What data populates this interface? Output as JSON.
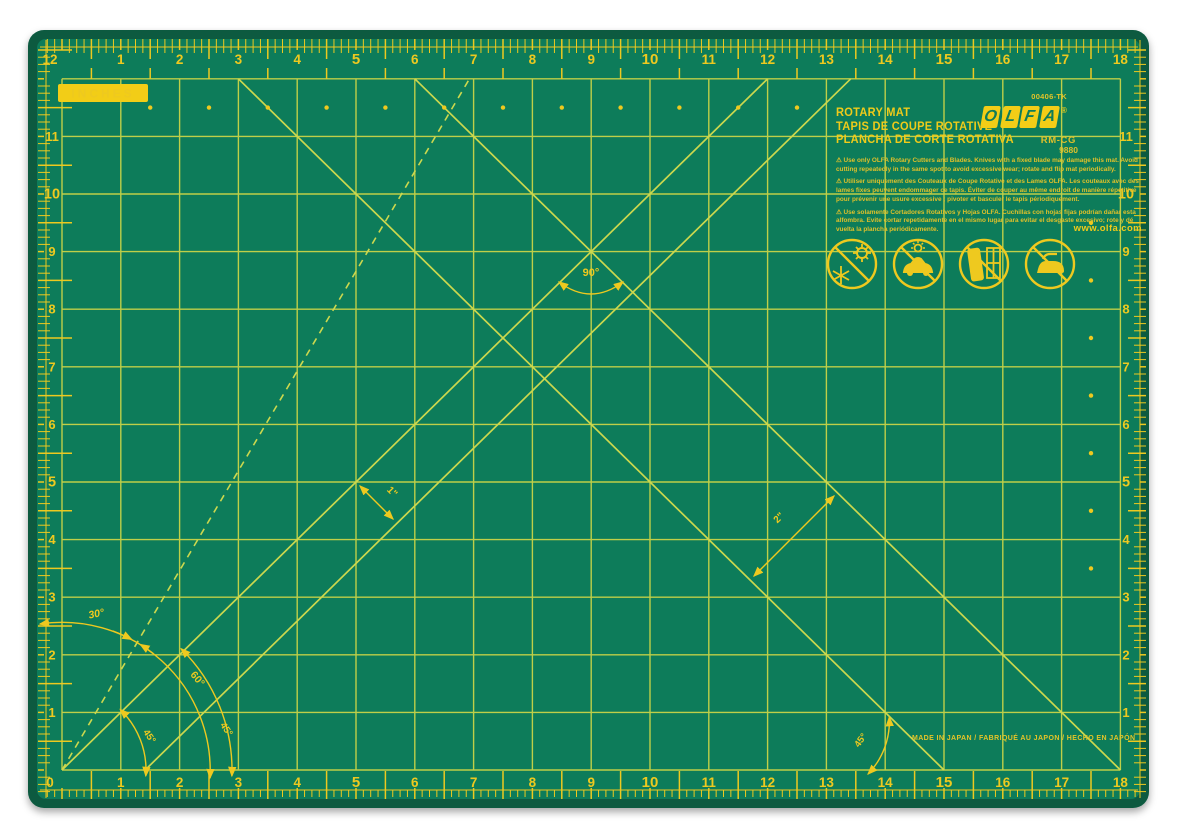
{
  "mat": {
    "unit_label": "INCHES",
    "brand": {
      "name": "OLFA",
      "letters": [
        "O",
        "L",
        "F",
        "A"
      ],
      "registered": "®"
    },
    "sku": "00406-TK",
    "model": "RM-CG",
    "model_number": "9880",
    "product_names": {
      "en": "ROTARY MAT",
      "fr": "TAPIS DE COUPE ROTATIVE",
      "es": "PLANCHA DE CORTE ROTATIVA"
    },
    "warnings": {
      "en": "⚠ Use only OLFA Rotary Cutters and Blades. Knives with a fixed blade may damage this mat. Avoid cutting repeatedly in the same spot to avoid excessive wear; rotate and flip mat periodically.",
      "fr": "⚠ Utiliser uniquement des Couteaux de Coupe Rotative et des Lames OLFA. Les couteaux avec des lames fixes peuvent endommager ce tapis. Éviter de couper au même endroit de manière répétitive pour prévenir une usure excessive ; pivoter et basculer le tapis périodiquement.",
      "es": "⚠ Use solamente Cortadores Rotativos y Hojas OLFA. Cuchillas con hojas fijas podrían dañar esta alfombra. Evite cortar repetidamente en el mismo lugar para evitar el desgaste excesivo; rote y dé vuelta la plancha periódicamente."
    },
    "website": "www.olfa.com",
    "made_in": "MADE IN  JAPAN / FABRIQUÉ AU JAPON / HECHO EN JAPÓN",
    "markings": {
      "right_angle": "90°",
      "angle_30": "30°",
      "angle_60": "60°",
      "angle_45": "45°",
      "one_inch": "1\"",
      "two_inch": "2\""
    },
    "rulers": {
      "top_numbers": [
        "1",
        "2",
        "3",
        "4",
        "5",
        "6",
        "7",
        "8",
        "9",
        "10",
        "11",
        "12",
        "13",
        "14",
        "15",
        "16",
        "17",
        "18"
      ],
      "bottom_numbers": [
        "1",
        "2",
        "3",
        "4",
        "5",
        "6",
        "7",
        "8",
        "9",
        "10",
        "11",
        "12",
        "13",
        "14",
        "15",
        "16",
        "17",
        "18"
      ],
      "left_numbers": [
        "1",
        "2",
        "3",
        "4",
        "5",
        "6",
        "7",
        "8",
        "9",
        "10",
        "11"
      ],
      "right_numbers": [
        "1",
        "2",
        "3",
        "4",
        "5",
        "6",
        "7",
        "8",
        "9",
        "10",
        "11"
      ],
      "top_left_corner": "12",
      "bottom_left_corner": "0",
      "bold_horizontal": [
        5,
        10,
        15
      ],
      "bold_vertical": [
        5,
        10
      ]
    },
    "icons": [
      "no-extreme-temperature-icon",
      "no-hot-car-icon",
      "no-window-sun-storage-icon",
      "no-ironing-icon"
    ],
    "colors": {
      "mat_green": "#0e7c5a",
      "border_green": "#0b5a41",
      "grid_yellow": "#bfcf48",
      "bias_yellow": "#ccd84e",
      "mark_yellow": "#eec91f",
      "badge_yellow": "#f2cd17"
    }
  }
}
